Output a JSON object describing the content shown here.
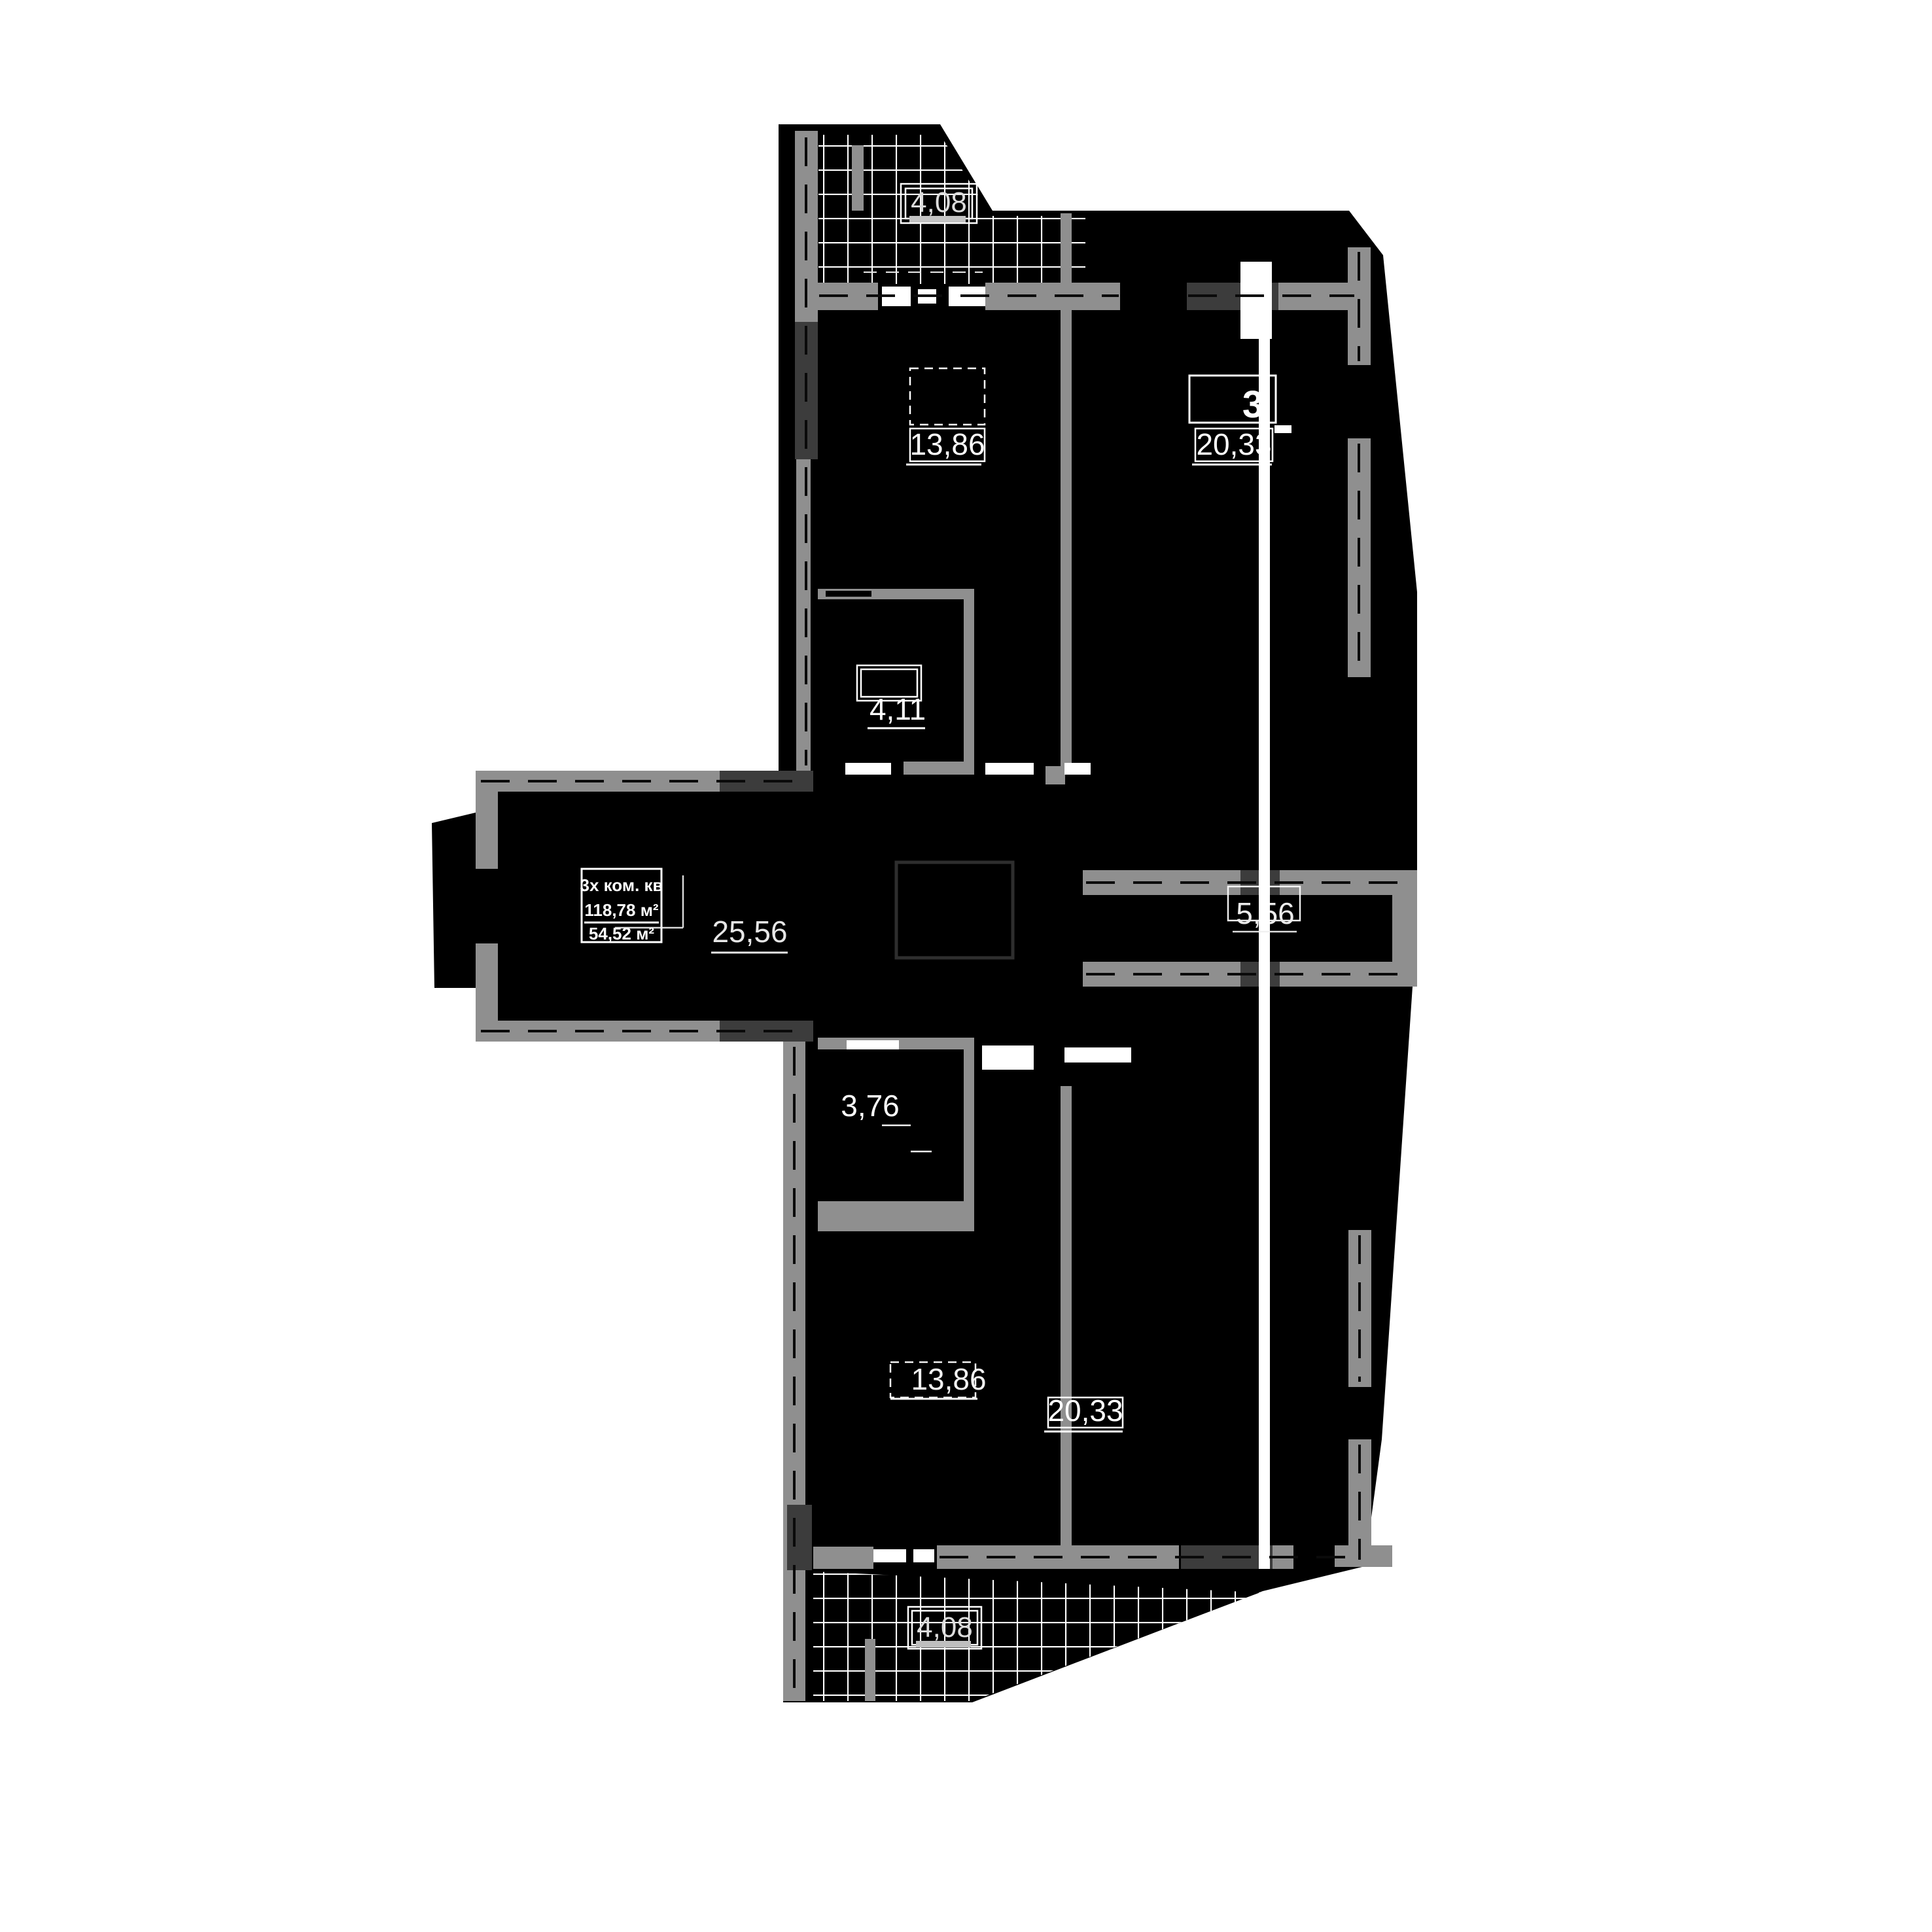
{
  "plan": {
    "apartment": {
      "type_label": "3х ком. кв",
      "total_area": "118,78 м²",
      "living_area": "54,52 м²"
    },
    "areas": {
      "balcony_top": "4,08",
      "room_top_left": "13,86",
      "room_top_right": "20,33",
      "bath_top": "4,11",
      "hall_center": "25,56",
      "hall_right": "5,56",
      "bath_bottom": "3,76",
      "room_bottom_left": "13,86",
      "room_bottom_right": "20,33",
      "balcony_bottom": "4,08"
    },
    "annotation_glyph": "3",
    "colors": {
      "background": "#ffffff",
      "plan_fill": "#000000",
      "wall_gray": "#8f8f8f",
      "wall_dark": "#3c3c3c",
      "label_text": "#ffffff",
      "hatch_line": "#ffffff"
    }
  }
}
